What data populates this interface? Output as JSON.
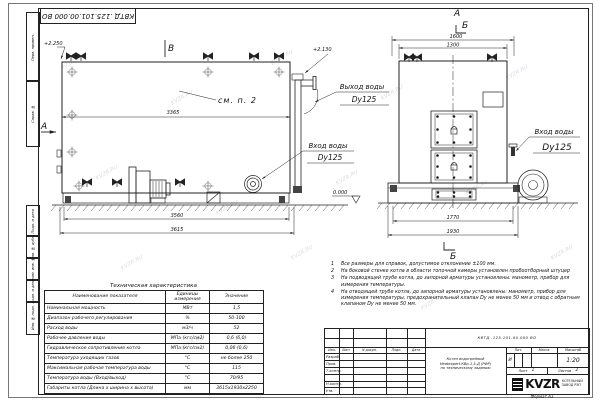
{
  "doc_number": "КВТД .125.101.00.000  ВО",
  "watermark": "KVZR.RU",
  "margin": {
    "labels": [
      "Перв. примен.",
      "Справ. №",
      "Подп. и дата",
      "Инв. № дубл.",
      "Взам. инв. №",
      "Подп. и дата",
      "Инв. № подл."
    ]
  },
  "side_view": {
    "label_b": "В",
    "label_a": "А",
    "see_note": "см. п. 2",
    "elev_top": "+2.250",
    "elev_outlet": "+2.130",
    "elev_zero": "0.000",
    "dim_inner": "3365",
    "dim_base": "3560",
    "dim_overall": "3615",
    "outlet_label": "Выход воды",
    "outlet_dn": "Dy125",
    "inlet_label": "Вход воды",
    "inlet_dn": "Dy125"
  },
  "front_view": {
    "label_a": "А",
    "label_b_top": "Б",
    "label_b_bottom": "Б",
    "dim_top1": "1600",
    "dim_top2": "1300",
    "dim_bot1": "1770",
    "dim_bot2": "1930",
    "inlet_label": "Вход воды",
    "inlet_dn": "Dy125"
  },
  "notes": [
    {
      "num": "1",
      "text": "Все размеры для справок, допустимое отклонение ±100 мм."
    },
    {
      "num": "2",
      "text": "На боковой стенке котла в области топочной камеры установлен пробоотборный штуцер"
    },
    {
      "num": "3",
      "text": "На подводящей трубе котла, до запорной арматуры установлены: манометр, прибор для измерения температуры."
    },
    {
      "num": "4",
      "text": "На отводящей трубе котла, до запорной арматуры установлены: манометр, прибор для измерения температуры, предохранительный клапан Dу не менее 50 мм и отвод с обратным клапаном Dу не менее 50 мм."
    }
  ],
  "table": {
    "title": "Техническая характеристика",
    "col_name": "Наименование показателя",
    "col_units": "Единицы измерения",
    "col_value": "Значение",
    "rows": [
      {
        "name": "Номинальная мощность",
        "units": "МВт",
        "value": "1,5"
      },
      {
        "name": "Диапазон рабочего регулирования",
        "units": "%",
        "value": "50-100"
      },
      {
        "name": "Расход воды",
        "units": "м3/ч",
        "value": "52"
      },
      {
        "name": "Рабочее давление воды",
        "units": "МПа (кгс/см2)",
        "value": "0,6 (6,0)"
      },
      {
        "name": "Гидравлическое сопротивление котла",
        "units": "МПа (кгс/см2)",
        "value": "0,06 (0,6)"
      },
      {
        "name": "Температура уходящих газов",
        "units": "°С",
        "value": "не более 250"
      },
      {
        "name": "Максимальная рабочая температура воды",
        "units": "°С",
        "value": "115"
      },
      {
        "name": "Температура воды (Вход/выход)",
        "units": "°С",
        "value": "70/95"
      },
      {
        "name": "Габариты котла (Длина х ширина х высота)",
        "units": "мм",
        "value": "3615х1930х2250"
      }
    ]
  },
  "title_block": {
    "number": "КВТД .125.101.00.000  ВО",
    "title_line1": "Котел водогрейный",
    "title_line2": "Heatexpert-КВр-1,5-Д (РФР)",
    "title_line3": "по техническому заданию",
    "col_izm": "Изм.",
    "col_list": "Лист",
    "col_docnum": "N докум.",
    "col_podp": "Подп.",
    "col_data": "Дата",
    "row_razrab": "Разраб.",
    "row_prov": "Пров.",
    "row_tkontr": "Т.контр.",
    "row_nkontr": "Н.контр.",
    "row_utv": "Утв.",
    "lit_header": "Лит.",
    "massa_header": "Масса",
    "masshtab_header": "Масштаб",
    "lit_value": "И",
    "masshtab_value": "1:20",
    "list_label": "Лист",
    "list_value": "1",
    "listov_label": "Листов",
    "listov_value": "2",
    "logo": "KVZR",
    "logo_sub1": "КОТЕЛЬНЫЙ",
    "logo_sub2": "ЗАВОД РЭП",
    "format": "Формат  А3"
  }
}
